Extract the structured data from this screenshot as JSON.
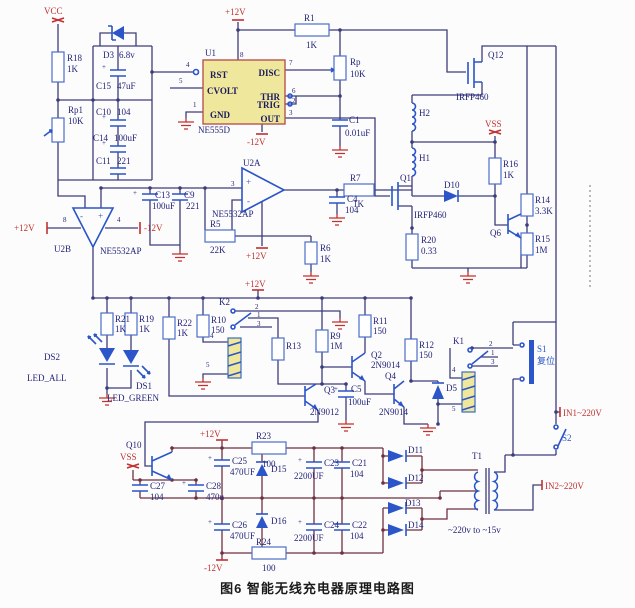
{
  "caption": "图6 智能无线充电器原理电路图",
  "pw": {
    "vcc": "VCC",
    "p12": "+12V",
    "n12": "-12V",
    "vss": "VSS",
    "in1": "IN1~220V",
    "in2": "IN2~220V"
  },
  "u1": {
    "ref": "U1",
    "part": "NE555D",
    "rst": "RST",
    "cvolt": "CVOLT",
    "gnd": "GND",
    "disc": "DISC",
    "thr": "THR",
    "trig": "TRIG",
    "out": "OUT",
    "p1": "1",
    "p2": "2",
    "p3": "3",
    "p4": "4",
    "p5": "5",
    "p6": "6",
    "p7": "7",
    "p8": "8"
  },
  "u2a": {
    "ref": "U2A",
    "part": "NE5532AP",
    "p3": "3",
    "plus": "+",
    "minus": "-"
  },
  "u2b": {
    "ref": "U2B",
    "part": "NE5532AP",
    "p8": "8",
    "p4": "4",
    "plus": "+",
    "minus": "-"
  },
  "res": {
    "r18": {
      "r": "R18",
      "v": "1K"
    },
    "rp1": {
      "r": "Rp1",
      "v": "10K"
    },
    "r1": {
      "r": "R1",
      "v": "1K"
    },
    "rp": {
      "r": "Rp",
      "v": "10K"
    },
    "r5": {
      "r": "R5",
      "v": "22K"
    },
    "r7": {
      "r": "R7",
      "v": "1K"
    },
    "r6": {
      "r": "R6",
      "v": "1K"
    },
    "r16": {
      "r": "R16",
      "v": "1K"
    },
    "r14": {
      "r": "R14",
      "v": "3.3K"
    },
    "r15": {
      "r": "R15",
      "v": "1M"
    },
    "r20": {
      "r": "R20",
      "v": "0.33"
    },
    "r21": {
      "r": "R21",
      "v": "1K"
    },
    "r19": {
      "r": "R19",
      "v": "1K"
    },
    "r22": {
      "r": "R22",
      "v": "1K"
    },
    "r10": {
      "r": "R10",
      "v": "150"
    },
    "r13": {
      "r": "R13"
    },
    "r9": {
      "r": "R9",
      "v": "1M"
    },
    "r11": {
      "r": "R11",
      "v": "150"
    },
    "r12": {
      "r": "R12",
      "v": "150"
    },
    "r23": {
      "r": "R23",
      "v": "100"
    },
    "r24": {
      "r": "R24",
      "v": "100"
    }
  },
  "cap": {
    "plus": "+",
    "c15": {
      "r": "C15",
      "v": "47uF"
    },
    "c10": {
      "r": "C10",
      "v": "104"
    },
    "c14": {
      "r": "C14",
      "v": "100uF"
    },
    "c11": {
      "r": "C11",
      "v": "221"
    },
    "c1": {
      "r": "C1",
      "v": "0.01uF"
    },
    "c13": {
      "r": "C13",
      "v": "100uF"
    },
    "c9": {
      "r": "C9",
      "v": "221"
    },
    "c4": {
      "r": "C4",
      "v": "104"
    },
    "c5": {
      "r": "C5",
      "v": "100uF"
    },
    "c23": {
      "r": "C23",
      "v": "2200UF"
    },
    "c21": {
      "r": "C21",
      "v": "104"
    },
    "c24": {
      "r": "C24",
      "v": "2200UF"
    },
    "c22": {
      "r": "C22",
      "v": "104"
    },
    "c25": {
      "r": "C25",
      "v": "470UF"
    },
    "c26": {
      "r": "C26",
      "v": "470UF"
    },
    "c27": {
      "r": "C27",
      "v": "104"
    },
    "c28": {
      "r": "C28",
      "v": "470u"
    }
  },
  "dio": {
    "d3": {
      "r": "D3",
      "v": "6.8v"
    },
    "d10": {
      "r": "D10"
    },
    "d5": {
      "r": "D5"
    },
    "d11": {
      "r": "D11"
    },
    "d12": {
      "r": "D12"
    },
    "d13": {
      "r": "D13"
    },
    "d14": {
      "r": "D14"
    },
    "d15": {
      "r": "D15"
    },
    "d16": {
      "r": "D16"
    }
  },
  "tr": {
    "q12": {
      "r": "Q12",
      "v": "IRFP460"
    },
    "q1": {
      "r": "Q1",
      "v": "IRFP460"
    },
    "q6": {
      "r": "Q6"
    },
    "q2": {
      "r": "Q2",
      "v": "2N9014"
    },
    "q3": {
      "r": "Q3",
      "v": "2N9012"
    },
    "q4": {
      "r": "Q4",
      "v": "2N9014"
    },
    "q10": {
      "r": "Q10"
    }
  },
  "ind": {
    "h1": "H1",
    "h2": "H2"
  },
  "t1": {
    "r": "T1",
    "note": "~220v to ~15v"
  },
  "k": {
    "k2": {
      "r": "K2",
      "p2": "2",
      "p1": "1",
      "p3": "3",
      "p4": "4",
      "p5": "5"
    },
    "k1": {
      "r": "K1",
      "p2": "2",
      "p1": "1",
      "p3": "3",
      "p4": "4",
      "p5": "5"
    }
  },
  "sw": {
    "s1": {
      "r": "S1",
      "cap": "复位"
    },
    "s2": {
      "r": "S2"
    }
  },
  "led": {
    "ds2": {
      "r": "DS2",
      "name": "LED_ALL"
    },
    "ds1": {
      "r": "DS1",
      "name": "LED_GREEN"
    }
  }
}
